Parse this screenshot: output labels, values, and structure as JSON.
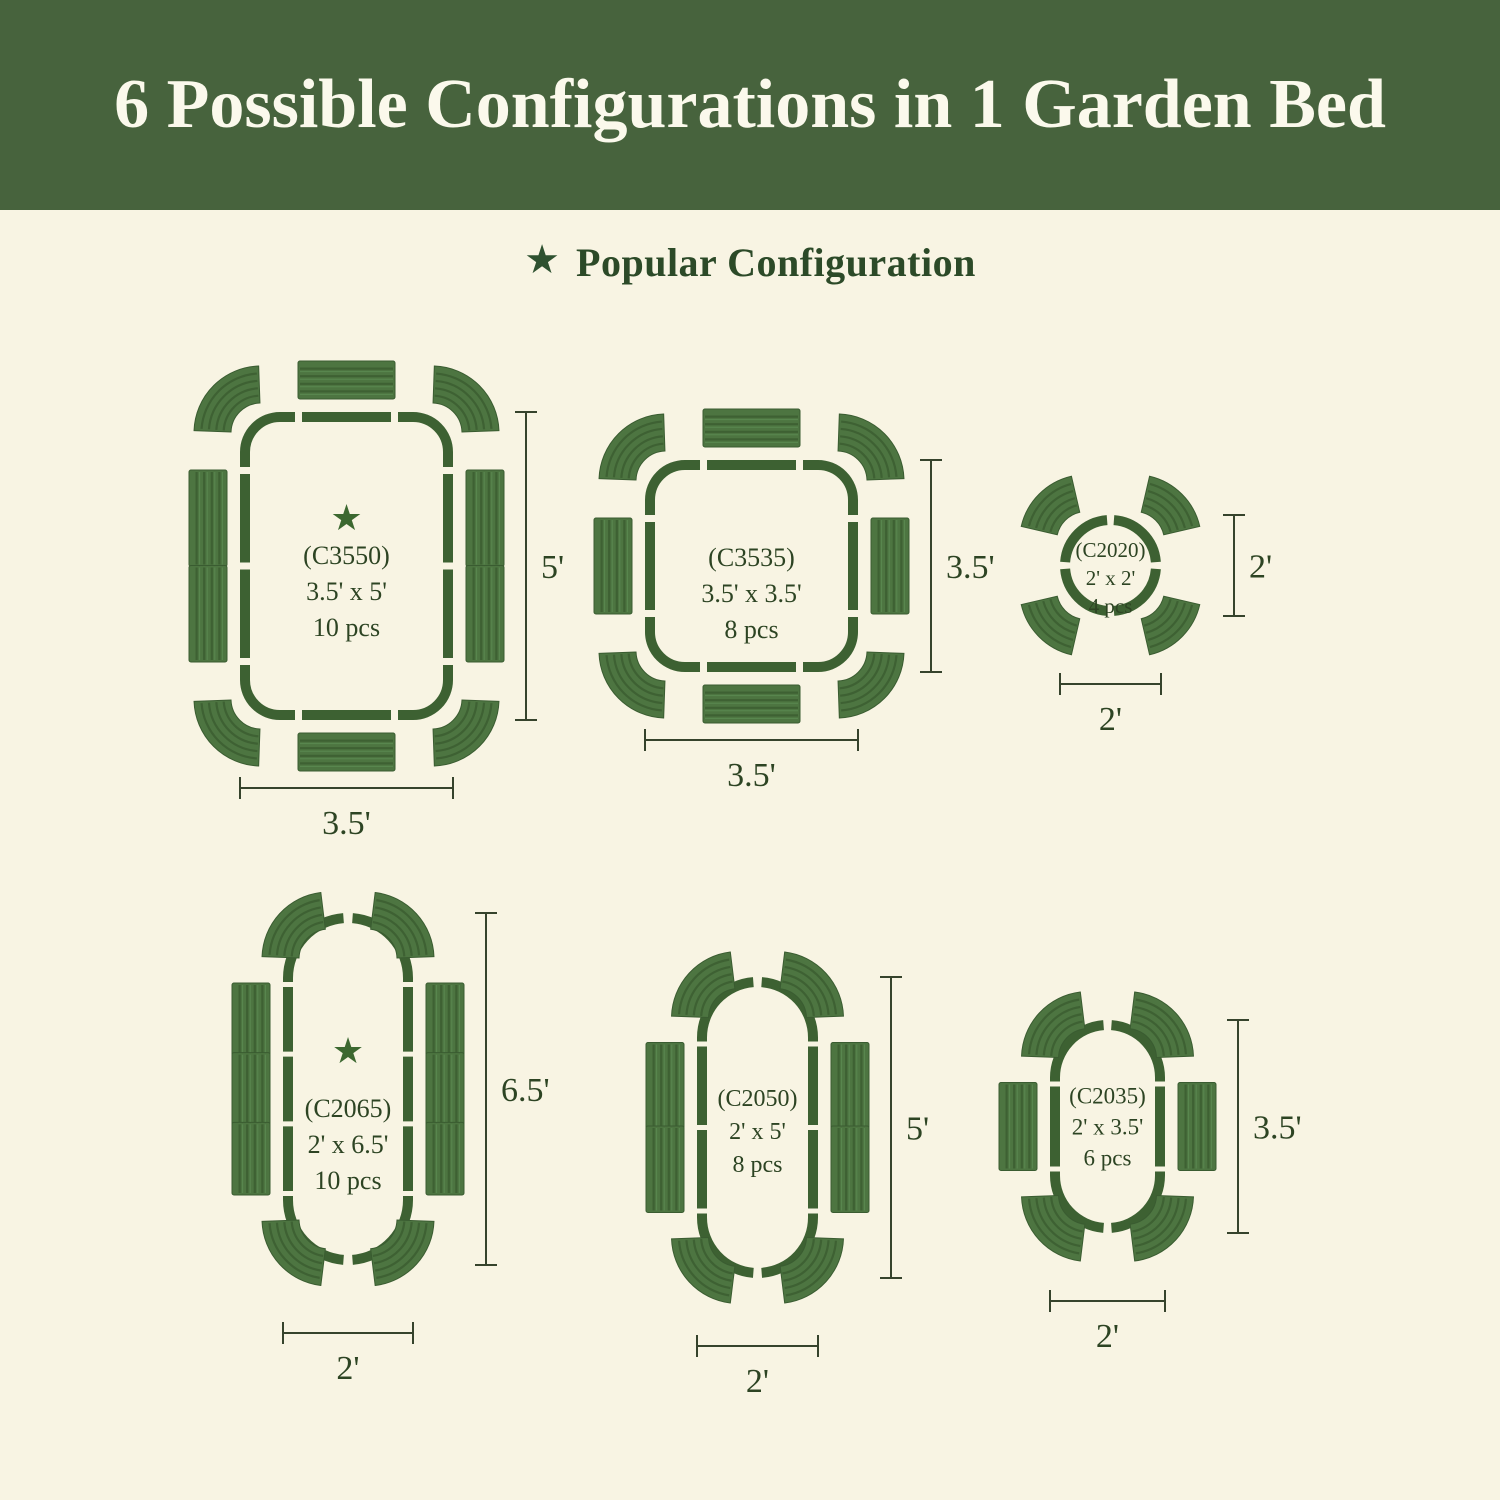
{
  "banner": {
    "title": "6 Possible Configurations in 1 Garden Bed"
  },
  "subheader": {
    "star_icon": "★",
    "label": "Popular Configuration"
  },
  "colors": {
    "banner_green": "#47633d",
    "cream_background": "#f8f4e3",
    "bed_outline_green": "#3d6132",
    "panel_green": "#4d7541",
    "panel_stripe_dark": "#3e6133",
    "panel_stripe_light": "#5a8850",
    "panel_edge": "#3a5c31",
    "text_green": "#2d4423",
    "star_green": "#3c6830",
    "dimension_line": "#36432c",
    "title_text": "#fbf9ec"
  },
  "configurations": [
    {
      "id": "C3550",
      "label": "(C3550)",
      "size": "3.5' x 5'",
      "pieces": "10 pcs",
      "popular": true,
      "star_icon": "★",
      "width_label": "3.5'",
      "height_label": "5'"
    },
    {
      "id": "C3535",
      "label": "(C3535)",
      "size": "3.5' x 3.5'",
      "pieces": "8 pcs",
      "popular": false,
      "star_icon": "",
      "width_label": "3.5'",
      "height_label": "3.5'"
    },
    {
      "id": "C2020",
      "label": "(C2020)",
      "size": "2' x 2'",
      "pieces": "4 pcs",
      "popular": false,
      "star_icon": "",
      "width_label": "2'",
      "height_label": "2'"
    },
    {
      "id": "C2065",
      "label": "(C2065)",
      "size": "2' x 6.5'",
      "pieces": "10 pcs",
      "popular": true,
      "star_icon": "★",
      "width_label": "2'",
      "height_label": "6.5'"
    },
    {
      "id": "C2050",
      "label": "(C2050)",
      "size": "2' x 5'",
      "pieces": "8 pcs",
      "popular": false,
      "star_icon": "",
      "width_label": "2'",
      "height_label": "5'"
    },
    {
      "id": "C2035",
      "label": "(C2035)",
      "size": "2' x 3.5'",
      "pieces": "6 pcs",
      "popular": false,
      "star_icon": "",
      "width_label": "2'",
      "height_label": "3.5'"
    }
  ]
}
